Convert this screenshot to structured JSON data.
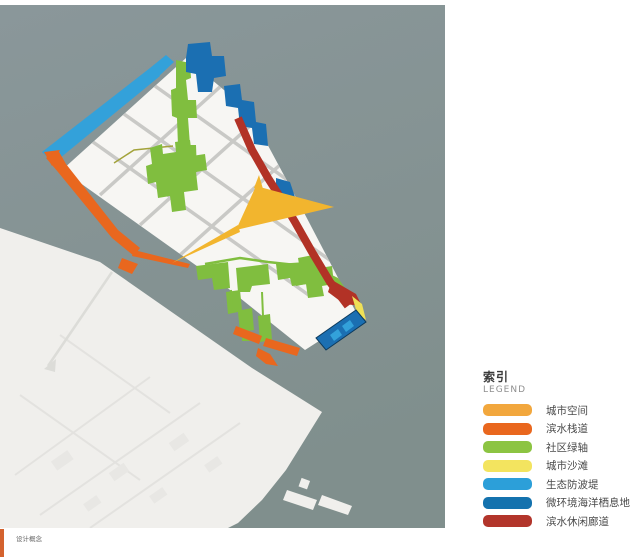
{
  "legend": {
    "title": "索引",
    "subtitle": "LEGEND",
    "items": [
      {
        "label": "城市空间",
        "color": "#F2A73D"
      },
      {
        "label": "滨水栈道",
        "color": "#E9671E"
      },
      {
        "label": "社区绿轴",
        "color": "#8CC442"
      },
      {
        "label": "城市沙滩",
        "color": "#F3E45F"
      },
      {
        "label": "生态防波堤",
        "color": "#2C9FD9"
      },
      {
        "label": "微环境海洋栖息地",
        "color": "#1472AE"
      },
      {
        "label": "滨水休闲廊道",
        "color": "#B2352B"
      }
    ]
  },
  "footer": {
    "caption": "设计概念",
    "bar_color": "#D4622E"
  },
  "map": {
    "colors": {
      "water": "#8A979A",
      "water_deep": "#808F8D",
      "land": "#F0EFEC",
      "land_texture": "#E4E3E0",
      "parcel": "#F7F6F3",
      "road": "#C9C9C6",
      "pier_line": "#DCDCD8",
      "urban_space": "#F2B52E",
      "boardwalk": "#E9671E",
      "green_axis": "#80BE3F",
      "green_path": "#A3A33B",
      "beach": "#EFE057",
      "breakwater": "#33A1DA",
      "habitat": "#1B6FB2",
      "habitat_dark": "#0D3A5C",
      "corridor": "#B23226"
    }
  }
}
